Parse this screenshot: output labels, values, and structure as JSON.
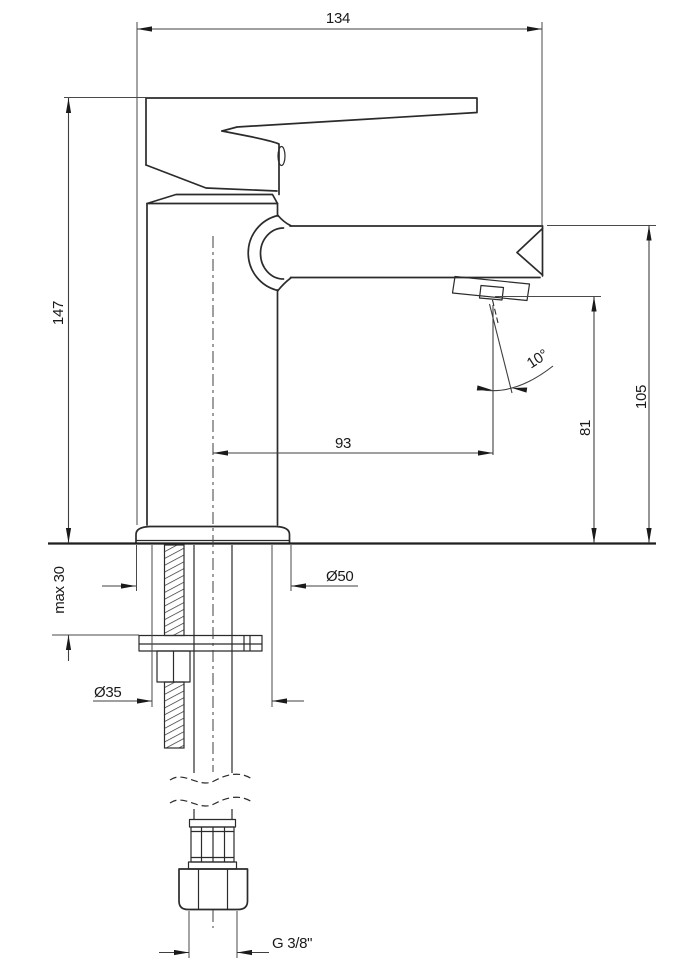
{
  "drawing": {
    "subject": "single-lever basin mixer faucet",
    "view": "side elevation with below-deck mounting section",
    "units": "mm",
    "colors": {
      "background": "#ffffff",
      "outline": "#2b2b2b",
      "dimension_lines": "#3f3f3f",
      "text": "#1a1a1a"
    },
    "dimensions": {
      "overall_width": "134",
      "overall_height": "147",
      "spout_top_height": "105",
      "aerator_height": "81",
      "spout_reach": "93",
      "stream_angle": "10°",
      "base_diameter": "Ø50",
      "mounting_hole_diameter": "Ø35",
      "max_deck_thickness": "max 30",
      "supply_thread": "G 3/8\""
    }
  }
}
